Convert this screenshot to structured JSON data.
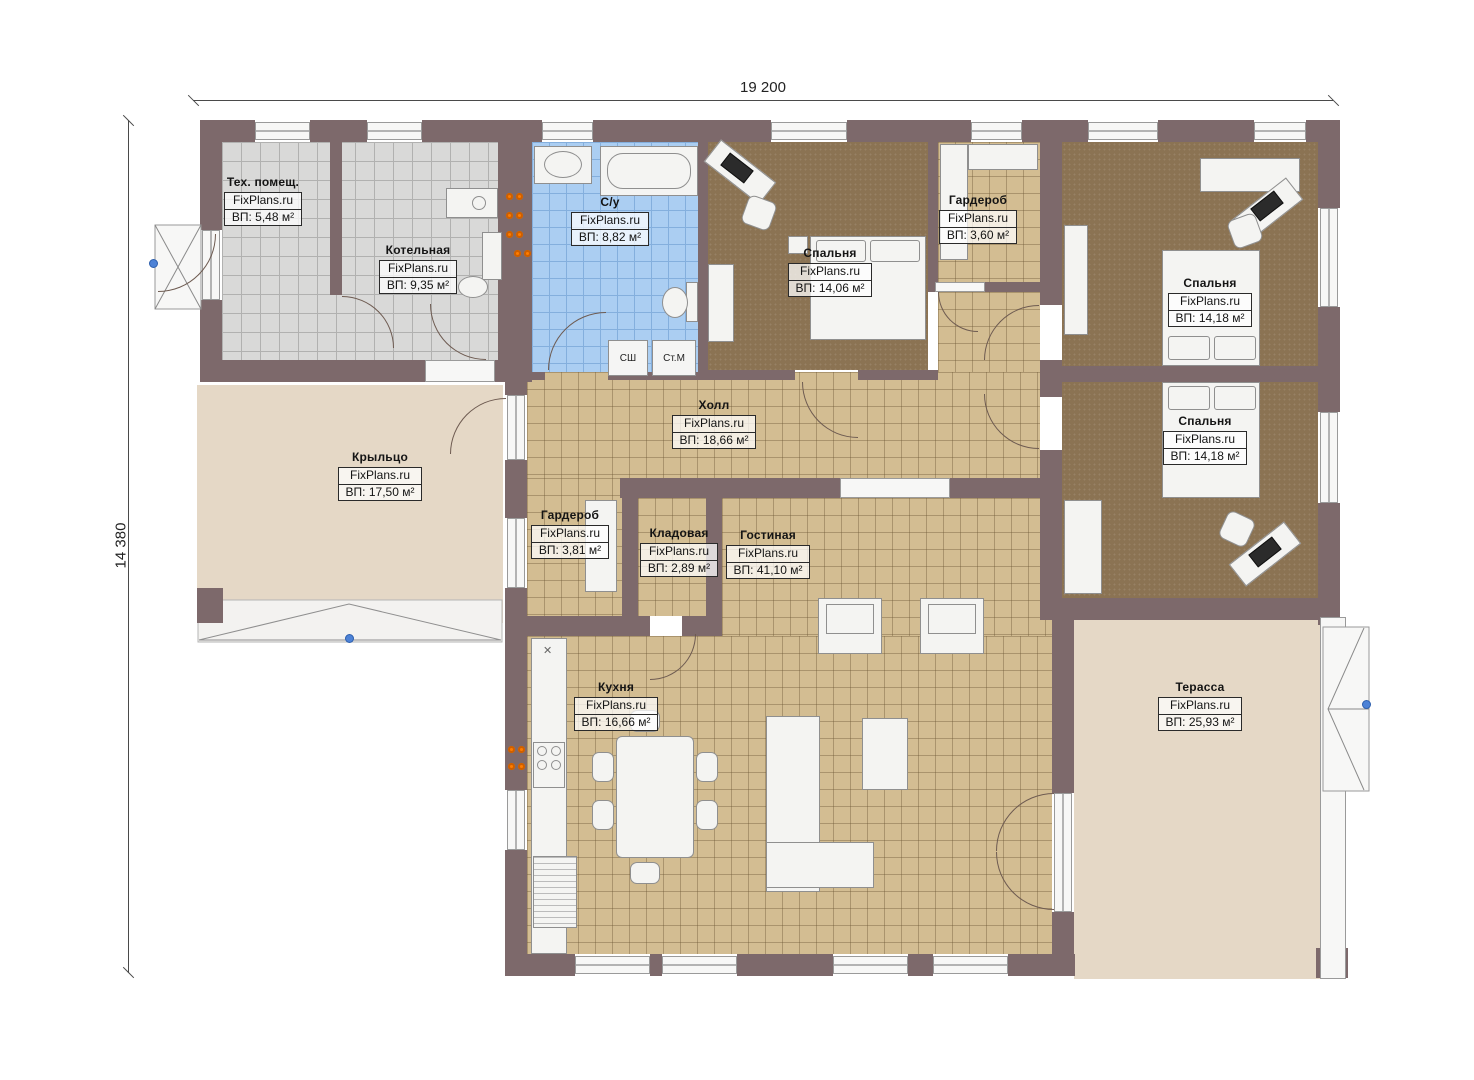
{
  "dim": {
    "width": "19 200",
    "height": "14 380"
  },
  "rooms": [
    {
      "key": "tech",
      "name": "Тех. помещ.",
      "site": "FixPlans.ru",
      "area": "ВП: 5,48 м²"
    },
    {
      "key": "boiler",
      "name": "Котельная",
      "site": "FixPlans.ru",
      "area": "ВП: 9,35 м²"
    },
    {
      "key": "bathroom",
      "name": "С/у",
      "site": "FixPlans.ru",
      "area": "ВП: 8,82 м²"
    },
    {
      "key": "bedroom-top",
      "name": "Спальня",
      "site": "FixPlans.ru",
      "area": "ВП: 14,06 м²"
    },
    {
      "key": "wardrobe-top",
      "name": "Гардероб",
      "site": "FixPlans.ru",
      "area": "ВП: 3,60 м²"
    },
    {
      "key": "bedroom-right-top",
      "name": "Спальня",
      "site": "FixPlans.ru",
      "area": "ВП: 14,18 м²"
    },
    {
      "key": "bedroom-right-bottom",
      "name": "Спальня",
      "site": "FixPlans.ru",
      "area": "ВП: 14,18 м²"
    },
    {
      "key": "hall",
      "name": "Холл",
      "site": "FixPlans.ru",
      "area": "ВП: 18,66 м²"
    },
    {
      "key": "porch",
      "name": "Крыльцо",
      "site": "FixPlans.ru",
      "area": "ВП: 17,50 м²"
    },
    {
      "key": "wardrobe-mid",
      "name": "Гардероб",
      "site": "FixPlans.ru",
      "area": "ВП: 3,81 м²"
    },
    {
      "key": "storage",
      "name": "Кладовая",
      "site": "FixPlans.ru",
      "area": "ВП: 2,89 м²"
    },
    {
      "key": "living",
      "name": "Гостиная",
      "site": "FixPlans.ru",
      "area": "ВП: 41,10 м²"
    },
    {
      "key": "kitchen",
      "name": "Кухня",
      "site": "FixPlans.ru",
      "area": "ВП: 16,66 м²"
    },
    {
      "key": "terrace",
      "name": "Терасса",
      "site": "FixPlans.ru",
      "area": "ВП: 25,93 м²"
    }
  ],
  "appliances": {
    "dryer": "СШ",
    "washer": "Ст.М"
  },
  "icons": {
    "sink_cross": "✕"
  },
  "colors": {
    "wall": "#7d696b",
    "tile_gray": "#d9d9d8",
    "tile_blue": "#abcef2",
    "tile_tan": "#d3bd92",
    "floor_brown": "#8b7353",
    "floor_beige": "#e5d8c6",
    "radiator": "#ff7c00",
    "marker_blue": "#4d82d6"
  }
}
